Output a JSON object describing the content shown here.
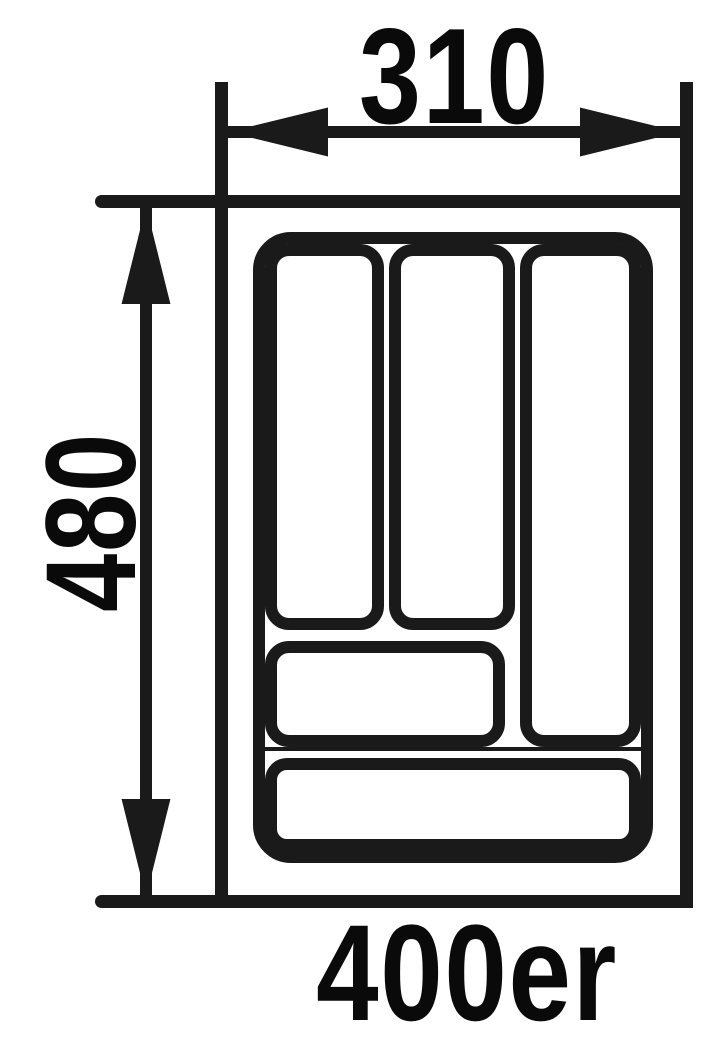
{
  "labels": {
    "width": "310",
    "height": "480",
    "size": "400er"
  },
  "colors": {
    "line": "#1a1a1a",
    "text": "#0a0a0a",
    "background": "#ffffff"
  }
}
